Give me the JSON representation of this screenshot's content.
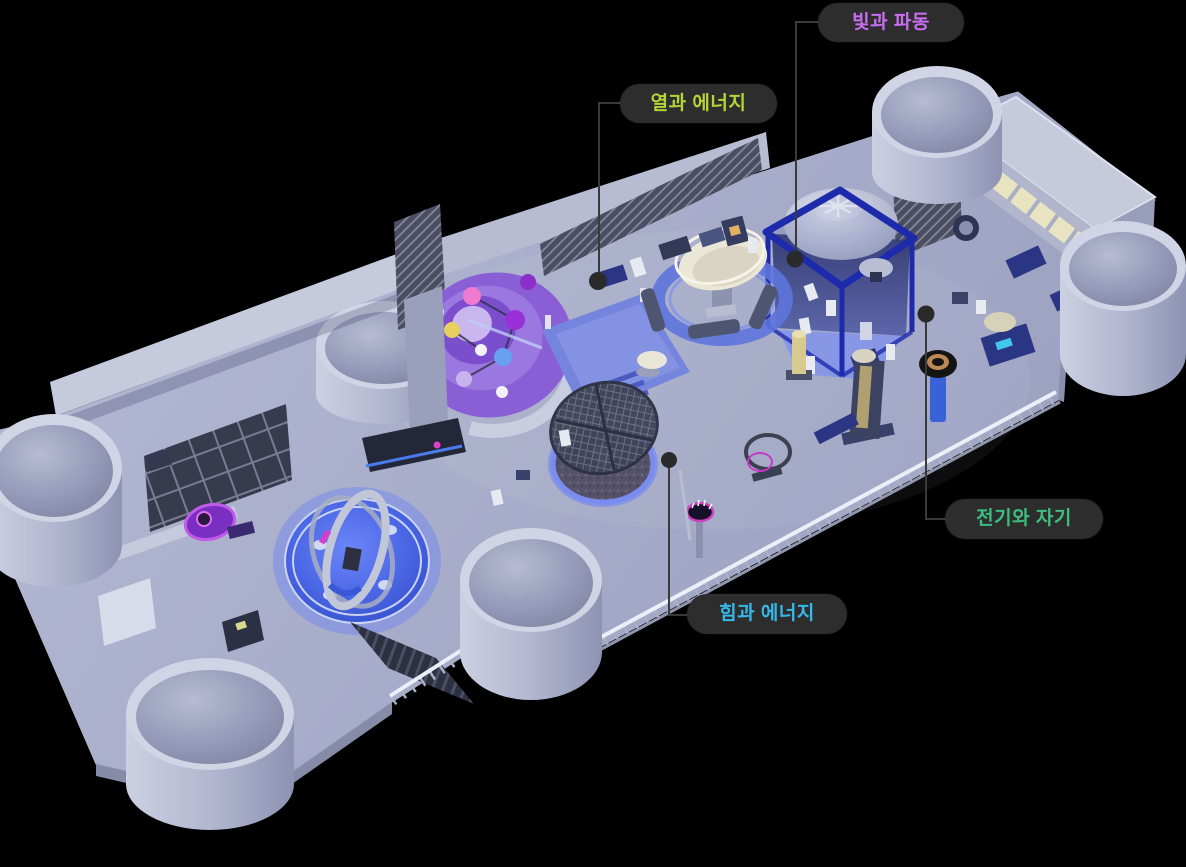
{
  "canvas": {
    "width": 1186,
    "height": 867,
    "background": "#000000"
  },
  "pill": {
    "background": "#2d2d2d",
    "line_color": "#3a3a3a",
    "marker_color": "#2a2a2a"
  },
  "zones": [
    {
      "id": "light-and-waves",
      "label": "빛과 파동",
      "color": "#c96ef2"
    },
    {
      "id": "heat-and-energy",
      "label": "열과 에너지",
      "color": "#b5d437"
    },
    {
      "id": "electricity-and-magnetism",
      "label": "전기와 자기",
      "color": "#3cbf7e"
    },
    {
      "id": "force-and-energy",
      "label": "힘과 에너지",
      "color": "#35b9ea"
    }
  ],
  "palette": {
    "floor": "#a9aecb",
    "wall_light": "#c6cadd",
    "wall_mid": "#b7bcd3",
    "wall_dark": "#4b4d60",
    "navy": "#1d2aac",
    "royal": "#2a3684",
    "platform_blue": "#7585dd",
    "glow_blue": "#4a66e4",
    "dome": "#b9bdd2",
    "cream": "#ebe7d6",
    "window_yellow": "#e8e4c2",
    "purple": "#8a5fd6",
    "railing": "#e6e9f3"
  }
}
